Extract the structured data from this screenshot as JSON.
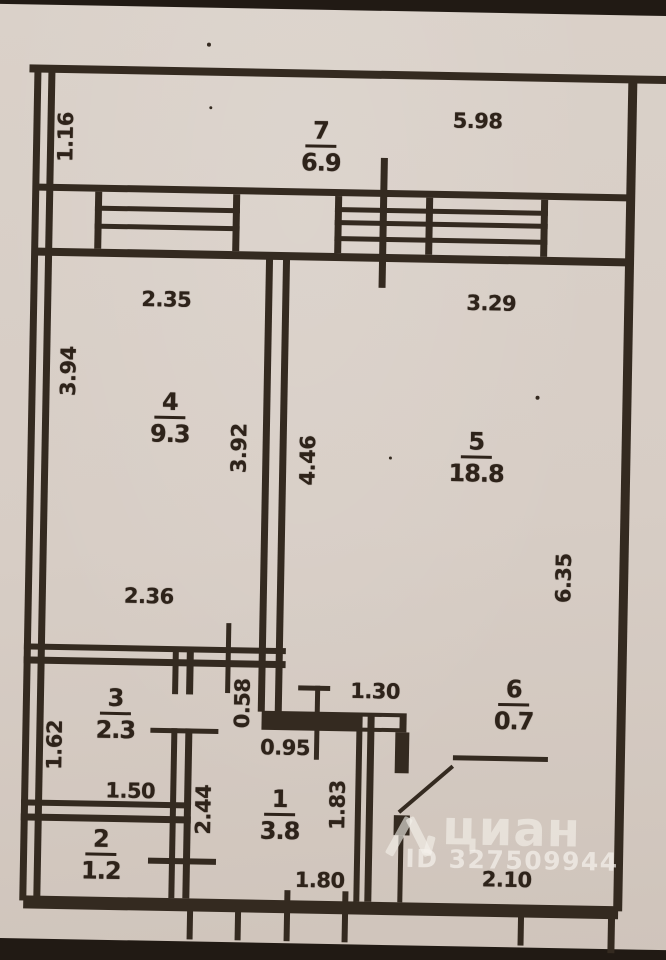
{
  "document": {
    "kind": "scanned apartment floor plan"
  },
  "colors": {
    "paper": "#d7cdc5",
    "ink": "#342a20",
    "page_edge_band": "#211a14",
    "watermark": "rgba(244,240,234,0.65)"
  },
  "watermark": {
    "brand": "циан",
    "listing_id": "ID 327509944"
  },
  "rooms": [
    {
      "name": "balcony",
      "number": "7",
      "area": "6.9"
    },
    {
      "name": "room-4",
      "number": "4",
      "area": "9.3"
    },
    {
      "name": "room-5",
      "number": "5",
      "area": "18.8"
    },
    {
      "name": "room-3",
      "number": "3",
      "area": "2.3"
    },
    {
      "name": "room-2",
      "number": "2",
      "area": "1.2"
    },
    {
      "name": "room-1",
      "number": "1",
      "area": "3.8"
    },
    {
      "name": "room-6",
      "number": "6",
      "area": "0.7"
    }
  ],
  "dimensions_m": {
    "d116": "1.16",
    "d598": "5.98",
    "d235": "2.35",
    "d394": "3.94",
    "d392": "3.92",
    "d446": "4.46",
    "d329": "3.29",
    "d635": "6.35",
    "d236": "2.36",
    "d162": "1.62",
    "d058": "0.58",
    "d095": "0.95",
    "d130": "1.30",
    "d150": "1.50",
    "d244": "2.44",
    "d183": "1.83",
    "d180": "1.80",
    "d210": "2.10"
  }
}
